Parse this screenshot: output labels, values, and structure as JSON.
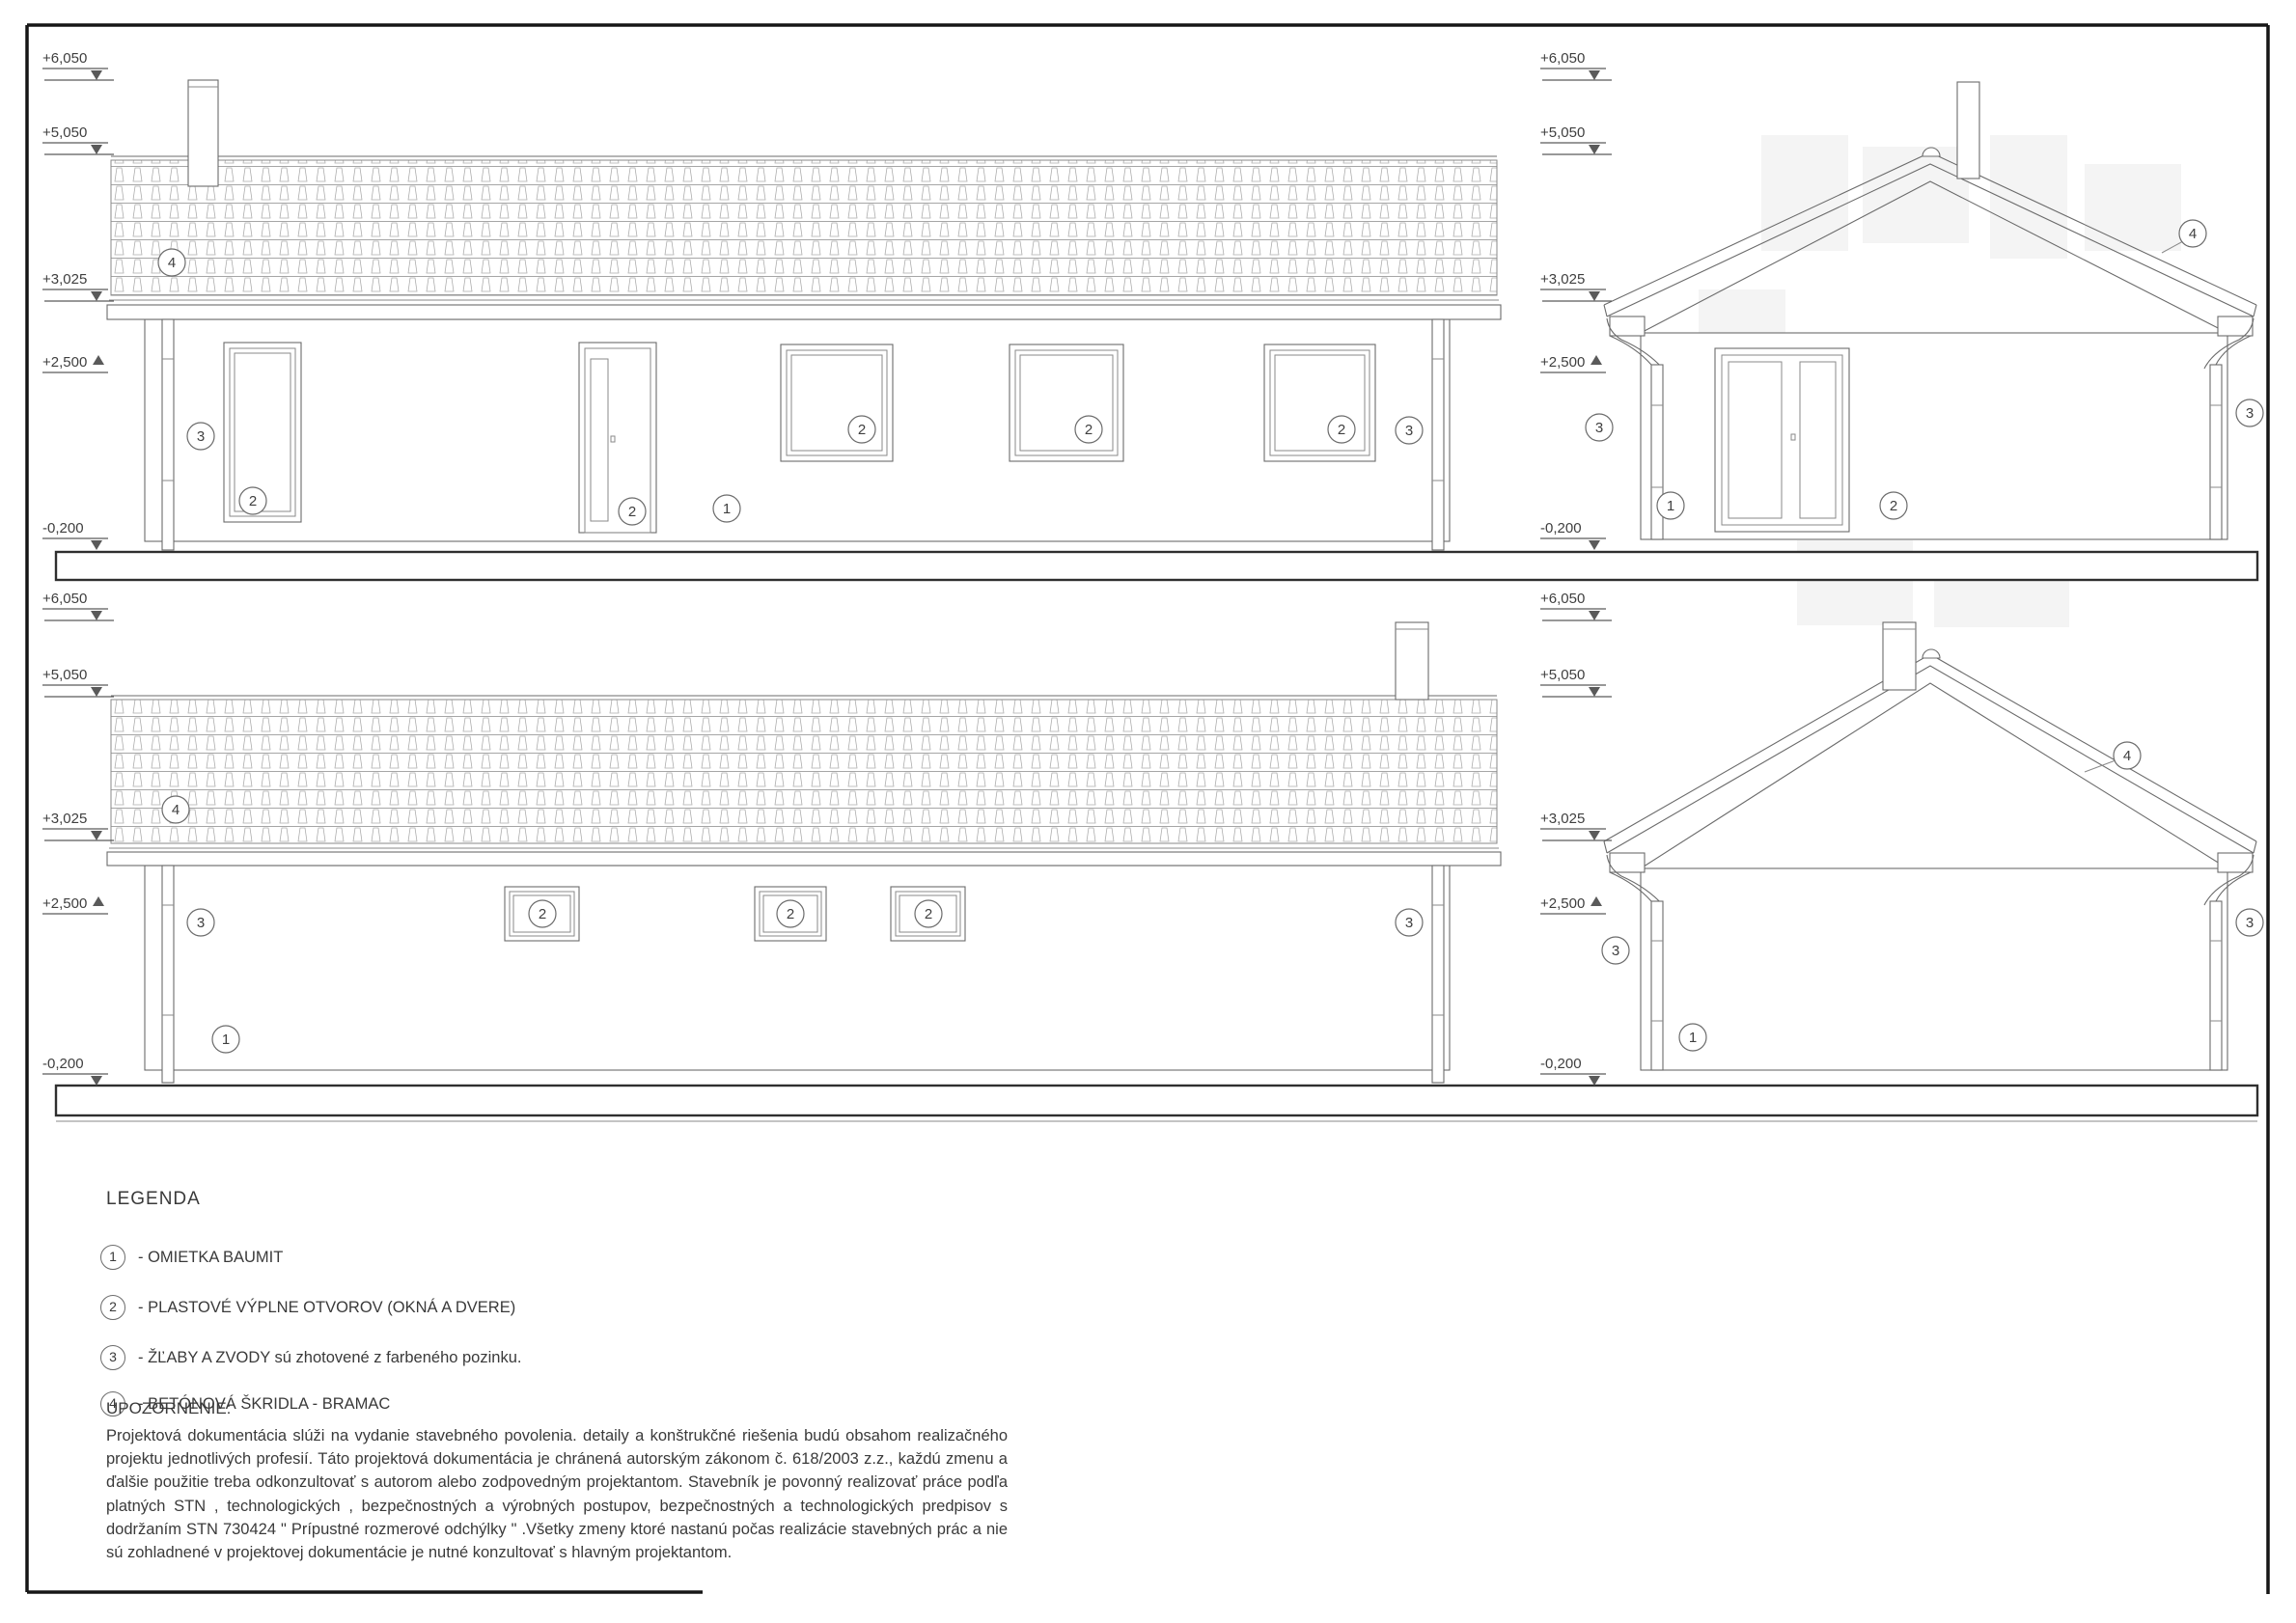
{
  "drawing": {
    "levels": {
      "v1": "+6,050",
      "v2": "+5,050",
      "v3": "+3,025",
      "v4": "+2,500",
      "v5": "-0,200"
    },
    "markers": {
      "m1": "1",
      "m2": "2",
      "m3": "3",
      "m4": "4"
    }
  },
  "legend": {
    "title": "LEGENDA",
    "items": [
      {
        "num": "1",
        "label": "- OMIETKA BAUMIT"
      },
      {
        "num": "2",
        "label": "- PLASTOVÉ VÝPLNE OTVOROV (OKNÁ A DVERE)"
      },
      {
        "num": "3",
        "label": "- ŽĽABY A ZVODY sú zhotovené z farbeného pozinku."
      },
      {
        "num": "4",
        "label": "- BETÓNOVÁ ŠKRIDLA - BRAMAC"
      }
    ]
  },
  "notice": {
    "title": "UPOZORNENIE:",
    "body": "Projektová dokumentácia slúži na vydanie stavebného povolenia. detaily a konštrukčné riešenia budú obsahom realizačného projektu jednotlivých profesií. Táto projektová dokumentácia je chránená autorským zákonom č. 618/2003 z.z., každú zmenu a ďalšie použitie treba odkonzultovať s autorom alebo zodpovedným projektantom. Stavebník je povonný realizovať práce podľa platných STN , technologických , bezpečnostných a výrobných postupov, bezpečnostných a technologických predpisov s dodržaním STN 730424 \" Prípustné rozmerové odchýlky \" .Všetky zmeny ktoré nastanú počas realizácie stavebných prác a nie sú zohladnené v projektovej dokumentácie je nutné konzultovať s hlavným projektantom."
  }
}
